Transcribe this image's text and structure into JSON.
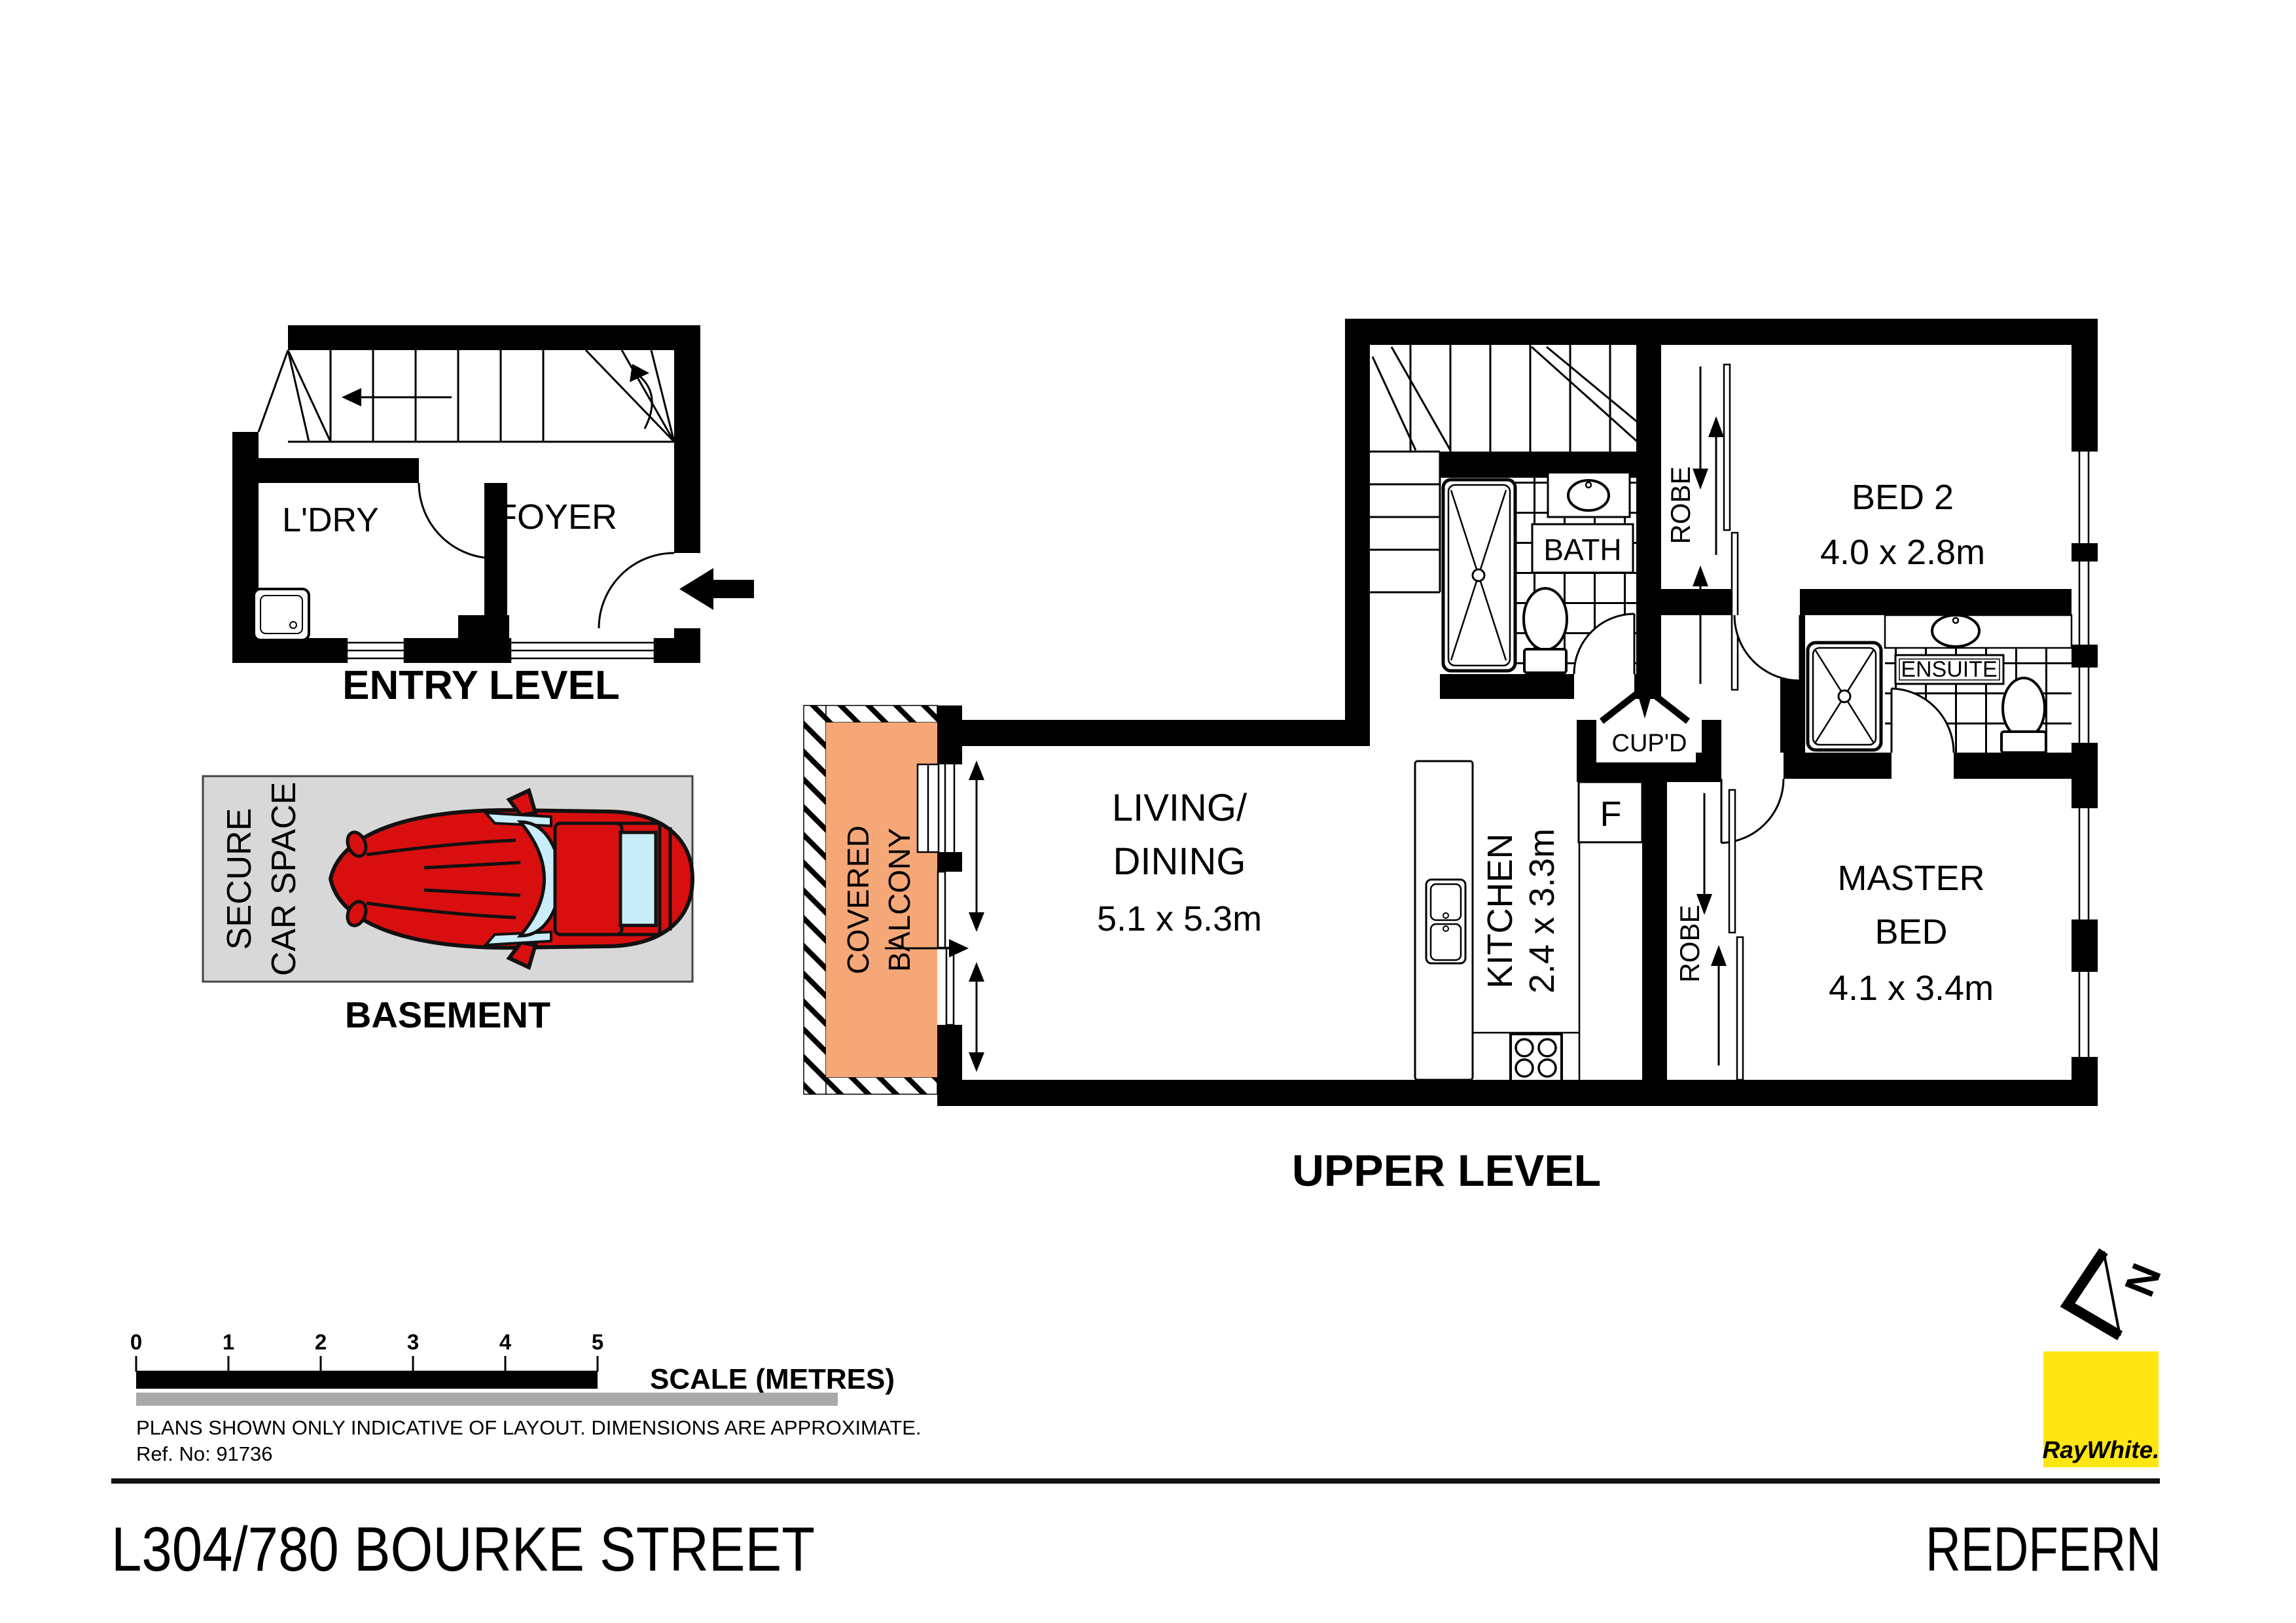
{
  "plans": {
    "entry": {
      "laundry": "L'DRY",
      "foyer": "FOYER",
      "caption": "ENTRY LEVEL"
    },
    "basement": {
      "car_space_line1": "SECURE",
      "car_space_line2": "CAR SPACE",
      "caption": "BASEMENT"
    },
    "upper": {
      "balcony_line1": "COVERED",
      "balcony_line2": "BALCONY",
      "living_line1": "LIVING/",
      "living_line2": "DINING",
      "living_dims": "5.1 x 5.3m",
      "kitchen_label": "KITCHEN",
      "kitchen_dims": "2.4 x 3.3m",
      "cupboard": "CUP'D",
      "fridge": "F",
      "robe_bed2": "ROBE",
      "robe_master": "ROBE",
      "bath": "BATH",
      "ensuite": "ENSUITE",
      "bed2_line1": "BED 2",
      "bed2_dims": "4.0 x 2.8m",
      "master_line1": "MASTER",
      "master_line2": "BED",
      "master_dims": "4.1 x 3.4m",
      "caption": "UPPER LEVEL"
    }
  },
  "scale_bar": {
    "ticks": [
      "0",
      "1",
      "2",
      "3",
      "4",
      "5"
    ],
    "label": "SCALE (METRES)"
  },
  "footer": {
    "disclaimer_line1": "PLANS SHOWN ONLY INDICATIVE OF LAYOUT.  DIMENSIONS ARE APPROXIMATE.",
    "disclaimer_line2": "Ref. No: 91736",
    "address": "L304/780 BOURKE STREET",
    "suburb": "REDFERN"
  },
  "branding": {
    "logo_text": "RayWhite.",
    "north_letter": "N",
    "colors": {
      "brand_yellow": "#FFE512",
      "logo_text_gray": "#58585C",
      "balcony_orange": "#F5A778",
      "carspace_gray": "#D8D8D8",
      "car_red": "#D90F0F",
      "glass_blue": "#C9EEFA"
    }
  }
}
